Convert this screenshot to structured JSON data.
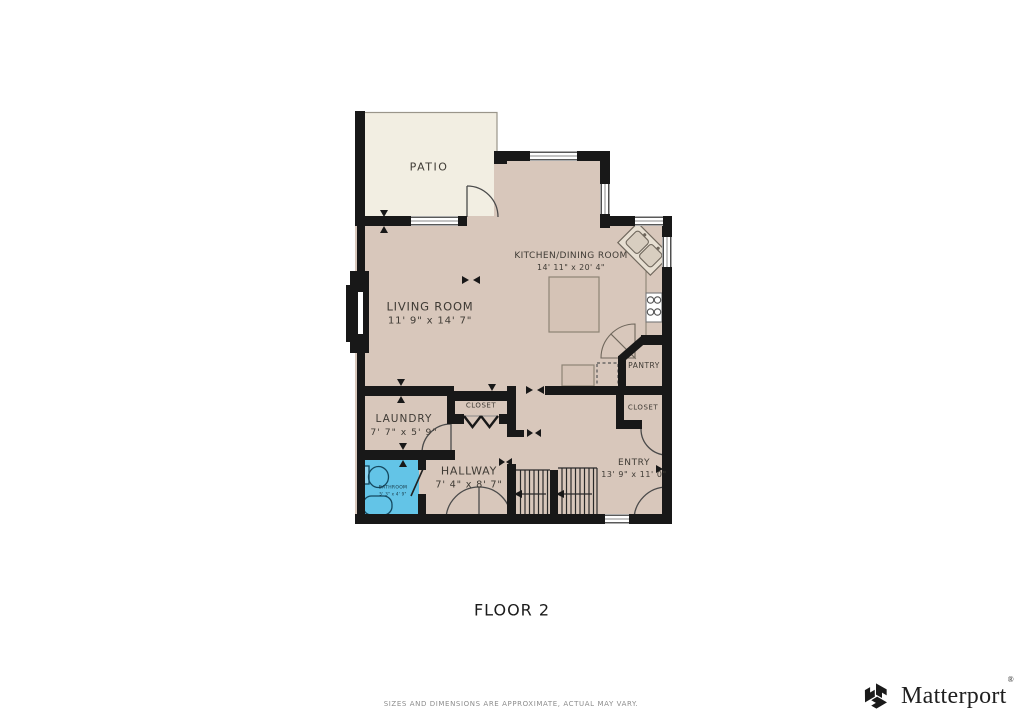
{
  "floor_plan": {
    "floor_label": "FLOOR 2",
    "rooms": [
      {
        "name": "PATIO",
        "dims": ""
      },
      {
        "name": "KITCHEN/DINING ROOM",
        "dims": "14' 11\" x 20' 4\""
      },
      {
        "name": "LIVING ROOM",
        "dims": "11' 9\" x 14' 7\""
      },
      {
        "name": "LAUNDRY",
        "dims": "7' 7\" x 5' 9\""
      },
      {
        "name": "CLOSET",
        "dims": ""
      },
      {
        "name": "PANTRY",
        "dims": ""
      },
      {
        "name": "CLOSET",
        "dims": ""
      },
      {
        "name": "ENTRY",
        "dims": "13' 9\" x 11' 0\""
      },
      {
        "name": "HALLWAY",
        "dims": "7' 4\" x 8' 7\""
      },
      {
        "name": "BATHROOM",
        "dims": "5' 3\" x 4' 9\""
      }
    ],
    "colors": {
      "floor": "#d8c7bb",
      "patio": "#f2eee2",
      "bathroom": "#63c4e7",
      "wall": "#181818"
    }
  },
  "footer": {
    "disclaimer": "SIZES AND DIMENSIONS ARE APPROXIMATE, ACTUAL MAY VARY.",
    "brand": "Matterport",
    "registered": "®"
  }
}
